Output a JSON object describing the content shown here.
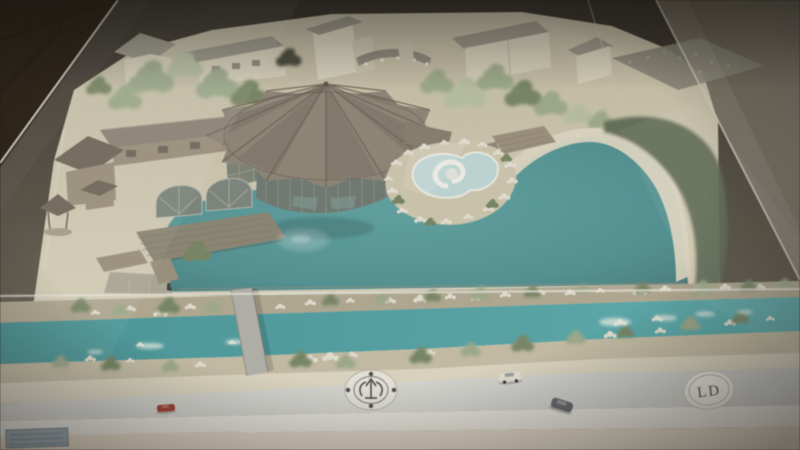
{
  "base_panel": {
    "right_emblem_text": "LD",
    "center_emblem_icon": "radial-logo-icon",
    "plaque_icon": "info-plaque"
  },
  "model_vehicles": [
    {
      "name": "red-car",
      "color": "#a93a2c"
    },
    {
      "name": "white-car",
      "color": "#e6e3d4"
    },
    {
      "name": "dark-car",
      "color": "#63676b"
    }
  ],
  "palette": {
    "bg_top": "#332d25",
    "bg_mid": "#4e4839",
    "bg_low": "#6a6454",
    "wood_corner": "#2a1f13",
    "wall_right": "#675f4c",
    "wall_right2": "#7d7667",
    "sand_back": "#c3bb9f",
    "sand": "#d5cdb2",
    "sand_light": "#ded7bf",
    "lagoon_light": "#58a4a3",
    "lagoon": "#4b9495",
    "lagoon_deep": "#417f81",
    "river": "#3f989b",
    "river_light": "#55b0b2",
    "tree": "#9cab86",
    "tree_light": "#b7c09c",
    "tree_dark": "#76865f",
    "roof": "#8c8372",
    "roof_dark": "#6f6755",
    "house_roof": "#999483",
    "cream": "#d8d1b7",
    "wood": "#9c9078",
    "glass_bldg": "#6e7970",
    "hill": "#5a684d",
    "rock": "#e7e1d0",
    "road": "#cdcecb",
    "base_white": "#ece9e0",
    "base_cream": "#e7dcca",
    "parking": "#ada893",
    "bridge": "#b3b1a8",
    "pool": "#bcd9d6",
    "car_red": "#a93a2c",
    "car_white": "#e6e3d4",
    "car_dark": "#63676b",
    "ink": "#4e4c42",
    "seam": "#e9e5d6"
  }
}
